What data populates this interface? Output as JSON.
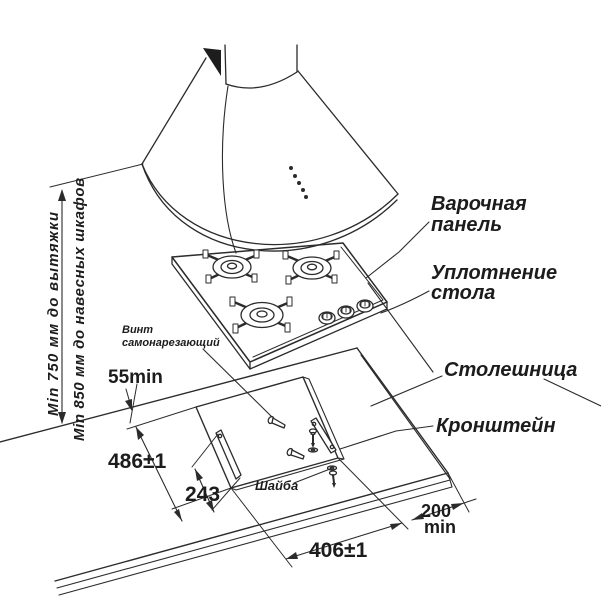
{
  "callouts": {
    "hob_line1": "Варочная",
    "hob_line2": "панель",
    "seal_line1": "Уплотнение",
    "seal_line2": "стола",
    "countertop": "Столешница",
    "bracket": "Кронштейн",
    "screw_line1": "Винт",
    "screw_line2": "самонарезающий",
    "washer": "Шайба"
  },
  "dimensions": {
    "hood_clearance": "Min 750 мм до вытяжки",
    "cabinets_clearance": "Min 850 мм до навесных шкафов",
    "rear_offset": "55min",
    "cutout_depth": "486±1",
    "bracket_span": "243",
    "cutout_width": "406±1",
    "right_clearance_value": "200",
    "right_clearance_unit": "min"
  },
  "colors": {
    "line": "#2b2b2b",
    "text": "#1c1c1c",
    "background": "#ffffff"
  }
}
